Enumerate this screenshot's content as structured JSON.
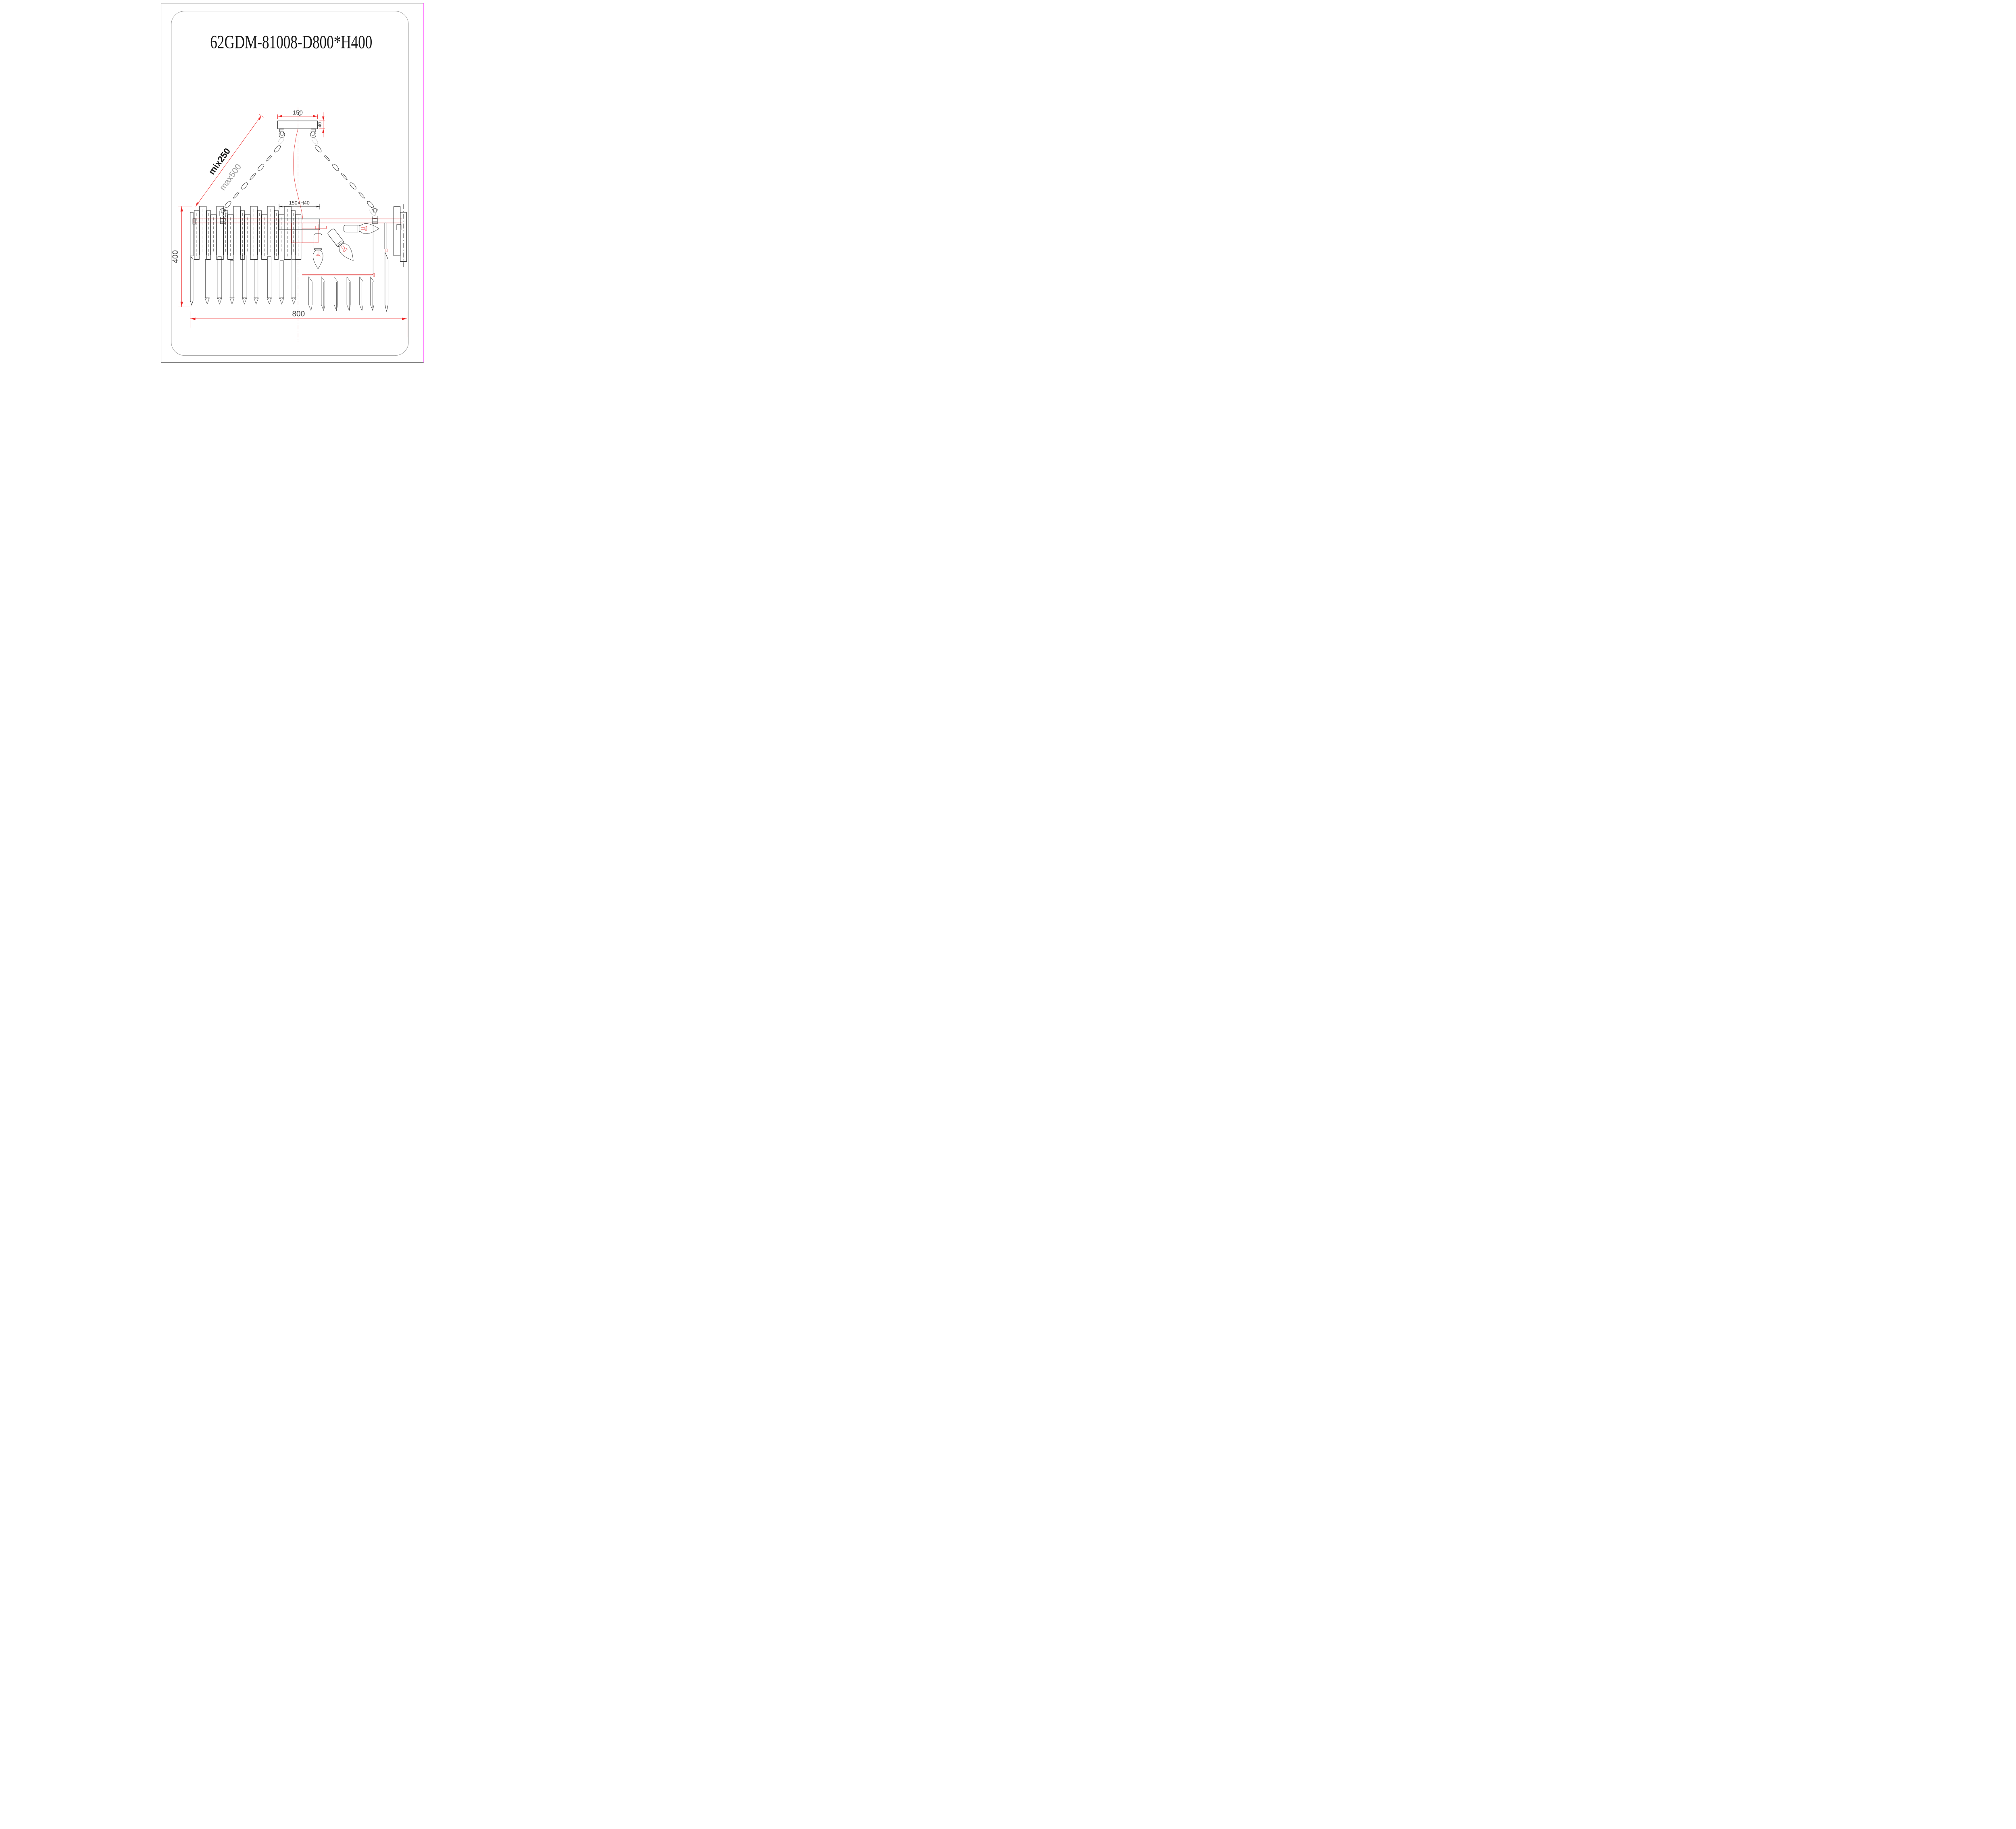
{
  "title": "62GDM-81008-D800*H400",
  "dimensions": {
    "canopy_width": "150",
    "canopy_height": "40",
    "suspension_min": "mix250",
    "suspension_max": "max500",
    "center_mount": "150×H40",
    "body_height": "400",
    "body_diameter": "800"
  },
  "colors": {
    "structure_black": "#1f1f1f",
    "structure_red": "#e03030",
    "dimension_red": "#ee2222",
    "extension_red": "#f0a0a0",
    "centerline_pink": "#e7a5a5",
    "ghost_gray": "#c4c4c4",
    "page_border_gray": "#9b9b9b",
    "page_border_bottom": "#3d3d3d",
    "page_border_magenta": "#ff4dff",
    "paper_white": "#ffffff"
  }
}
